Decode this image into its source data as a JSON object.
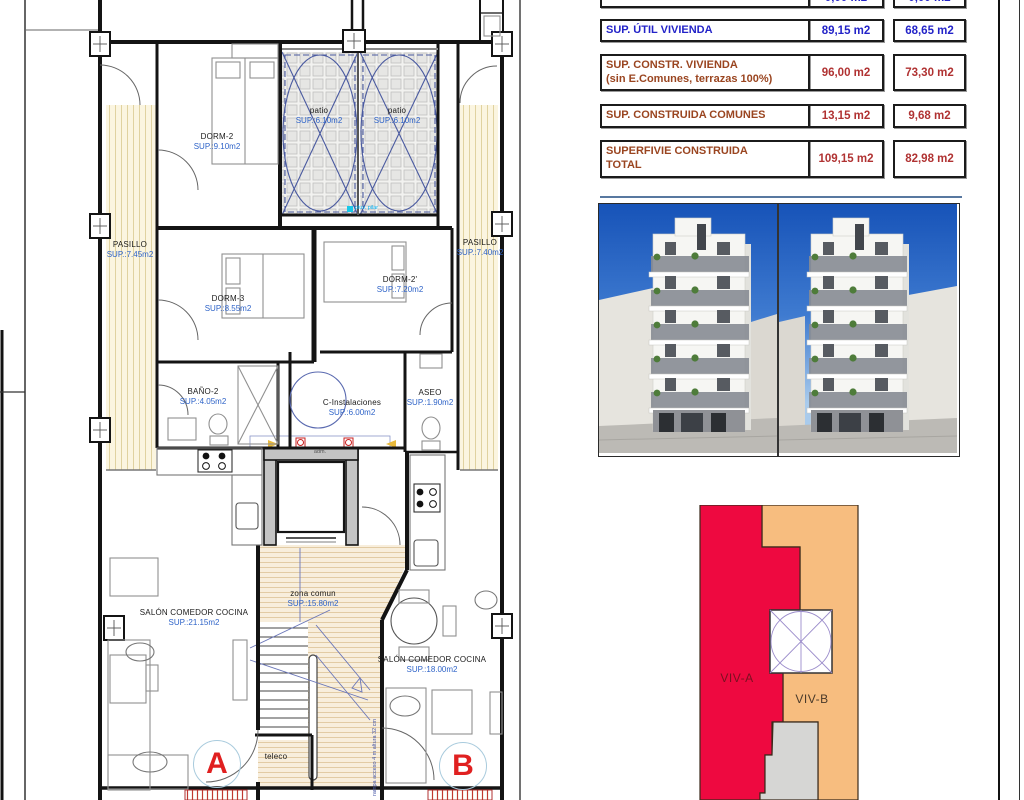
{
  "table": {
    "rows": [
      {
        "label": "SUP. TERRAZA-2",
        "v1": "0,00 m2",
        "v2": "0,00 m2"
      },
      {
        "label": "SUP. ÚTIL VIVIENDA",
        "v1": "89,15 m2",
        "v2": "68,65 m2"
      },
      {
        "label": "SUP. CONSTR. VIVIENDA",
        "label2": "(sin E.Comunes, terrazas 100%)",
        "v1": "96,00 m2",
        "v2": "73,30 m2"
      },
      {
        "label": "SUP. CONSTRUIDA COMUNES",
        "v1": "13,15 m2",
        "v2": "9,68 m2"
      },
      {
        "label": "SUPERFIVIE CONSTRUIDA",
        "label2": "TOTAL",
        "v1": "109,15 m2",
        "v2": "82,98 m2"
      }
    ]
  },
  "plan": {
    "rooms": [
      {
        "name": "DORM-2",
        "area": "SUP.:9.10m2"
      },
      {
        "name": "patio",
        "area": "SUP.:6.10m2"
      },
      {
        "name": "patio",
        "area": "SUP.:6.10m2"
      },
      {
        "name": "PASILLO",
        "area": "SUP.:7.45m2"
      },
      {
        "name": "PASILLO",
        "area": "SUP.:7.40m2"
      },
      {
        "name": "DORM-3",
        "area": "SUP.:8.55m2"
      },
      {
        "name": "DORM-2'",
        "area": "SUP.:7.20m2"
      },
      {
        "name": "BAÑO-2",
        "area": "SUP.:4.05m2"
      },
      {
        "name": "C-Instalaciones",
        "area": "SUP.:6.00m2"
      },
      {
        "name": "ASEO",
        "area": "SUP.:1.90m2"
      },
      {
        "name": "SALÓN COMEDOR COCINA",
        "area": "SUP.:21.15m2"
      },
      {
        "name": "zona comun",
        "area": "SUP.:15.80m2"
      },
      {
        "name": "SALÓN COMEDOR COCINA",
        "area": "SUP.:18.00m2"
      },
      {
        "name": "teleco",
        "area": ""
      }
    ],
    "units": {
      "a": "A",
      "b": "B"
    },
    "notes": {
      "adm": "adm.",
      "pluv": "pluv. pilar",
      "ramp": "rampa acceso 4 m altura 32 cm"
    }
  },
  "diagram": {
    "viv_a": "VIV-A",
    "viv_b": "VIV-B"
  },
  "colors": {
    "accent_red": "#EE0940",
    "accent_orange": "#F7BD7F",
    "area_blue": "#2E63C8",
    "table_blue": "#2323C8",
    "table_maroon": "#9A4520",
    "table_red": "#B03232"
  }
}
